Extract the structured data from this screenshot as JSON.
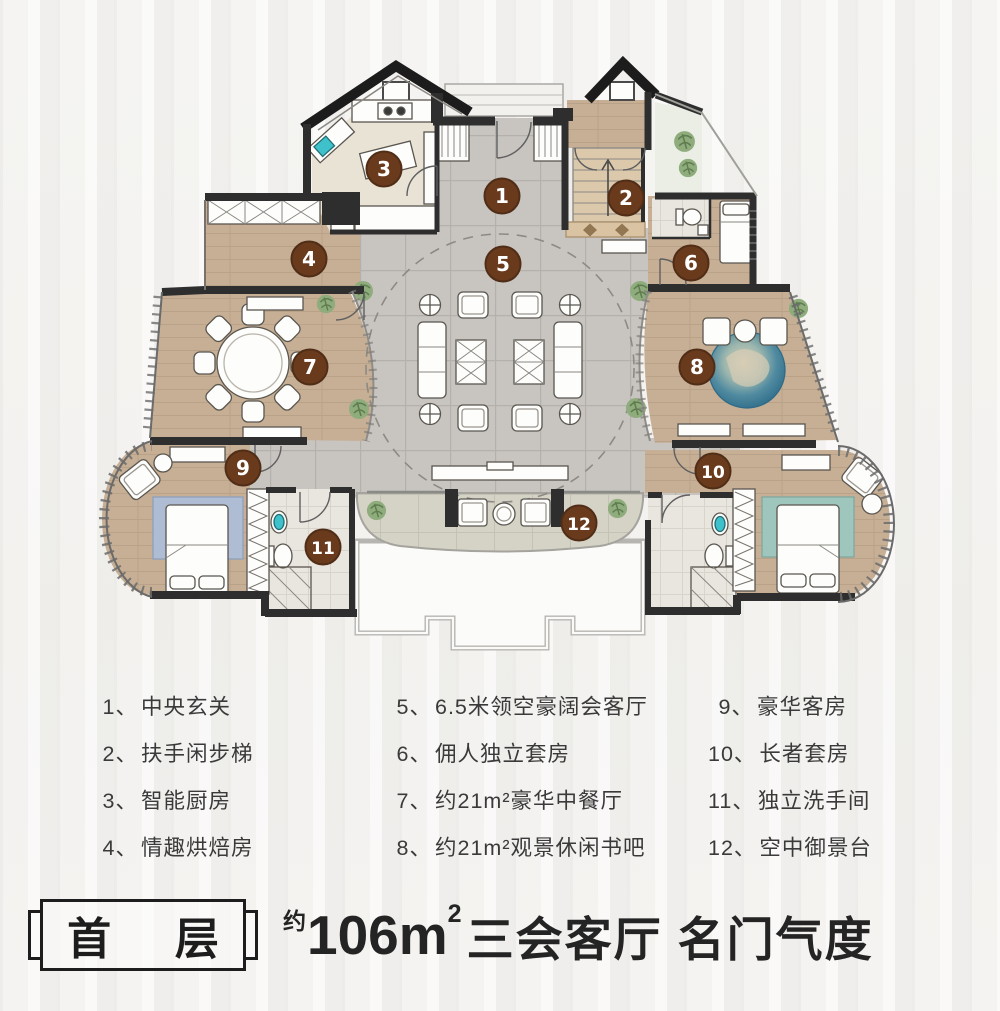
{
  "legend": {
    "columns": [
      [
        {
          "num": "1、",
          "label": "中央玄关"
        },
        {
          "num": "2、",
          "label": "扶手闲步梯"
        },
        {
          "num": "3、",
          "label": "智能厨房"
        },
        {
          "num": "4、",
          "label": "情趣烘焙房"
        }
      ],
      [
        {
          "num": "5、",
          "label": "6.5米领空豪阔会客厅"
        },
        {
          "num": "6、",
          "label": "佣人独立套房"
        },
        {
          "num": "7、",
          "label": "约21m²豪华中餐厅"
        },
        {
          "num": "8、",
          "label": "约21m²观景休闲书吧"
        }
      ],
      [
        {
          "num": "9、",
          "label": "豪华客房"
        },
        {
          "num": "10、",
          "label": "长者套房"
        },
        {
          "num": "11、",
          "label": "独立洗手间"
        },
        {
          "num": "12、",
          "label": "空中御景台"
        }
      ]
    ]
  },
  "footer": {
    "floor_label": "首层",
    "title_prefix": "约",
    "title_area": "106m",
    "title_sup": "2",
    "title_rest": "三会客厅 名门气度"
  },
  "floor_plan": {
    "markers": [
      {
        "n": "1",
        "x": 502,
        "y": 196
      },
      {
        "n": "2",
        "x": 626,
        "y": 198
      },
      {
        "n": "3",
        "x": 384,
        "y": 169
      },
      {
        "n": "4",
        "x": 309,
        "y": 259
      },
      {
        "n": "5",
        "x": 503,
        "y": 264
      },
      {
        "n": "6",
        "x": 691,
        "y": 263
      },
      {
        "n": "7",
        "x": 310,
        "y": 367
      },
      {
        "n": "8",
        "x": 697,
        "y": 367
      },
      {
        "n": "9",
        "x": 243,
        "y": 468
      },
      {
        "n": "10",
        "x": 713,
        "y": 471
      },
      {
        "n": "11",
        "x": 323,
        "y": 547
      },
      {
        "n": "12",
        "x": 579,
        "y": 523
      }
    ]
  },
  "colors": {
    "marker_fill": "#6a3a1d",
    "marker_ring": "#502d16",
    "marker_text": "#ffffff",
    "wall": "#2e2e2e",
    "wood": "#c6af95",
    "tile": "#c8c5c1",
    "accent_teal": "#3ec1ca",
    "plant_green": "#8fac7d"
  }
}
